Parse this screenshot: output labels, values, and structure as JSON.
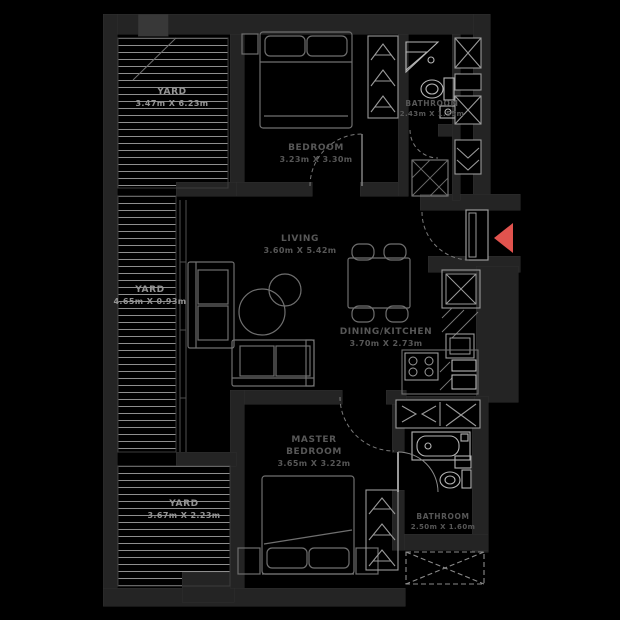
{
  "floor_plan": {
    "background_color": "#000000",
    "wall_color": "#242424",
    "furniture_line_color": "#6f6f6f",
    "fixture_line_color": "#b5b5b5",
    "hatch_color": "#9e9e9e",
    "room_label_color": "#575757",
    "yard_label_color": "#949494",
    "accent_color": "#e1534e"
  },
  "labels": {
    "yard_top": {
      "name": "YARD",
      "dims": "3.47m X 6.23m"
    },
    "yard_mid": {
      "name": "YARD",
      "dims": "4.65m X 0.93m"
    },
    "yard_bottom": {
      "name": "YARD",
      "dims": "3.67m X 2.23m"
    },
    "bedroom": {
      "name": "BEDROOM",
      "dims": "3.23m X 3.30m"
    },
    "living": {
      "name": "LIVING",
      "dims": "3.60m X 5.42m"
    },
    "dining": {
      "name": "DINING/KITCHEN",
      "dims": "3.70m X 2.73m"
    },
    "master_bedroom": {
      "name_line1": "MASTER",
      "name_line2": "BEDROOM",
      "dims": "3.65m X 3.22m"
    },
    "bathroom_top": {
      "name": "BATHROOM",
      "dims": "2.43m X 1.55m"
    },
    "bathroom_bottom": {
      "name": "BATHROOM",
      "dims": "2.50m X 1.60m"
    }
  },
  "icons": {
    "entry_arrow": "entry-direction-arrow",
    "wardrobe_hanger": "clothes-hanger",
    "shaft_cross": "duct-shaft-x",
    "ac_unit": "ac-condenser-dashed-box"
  }
}
